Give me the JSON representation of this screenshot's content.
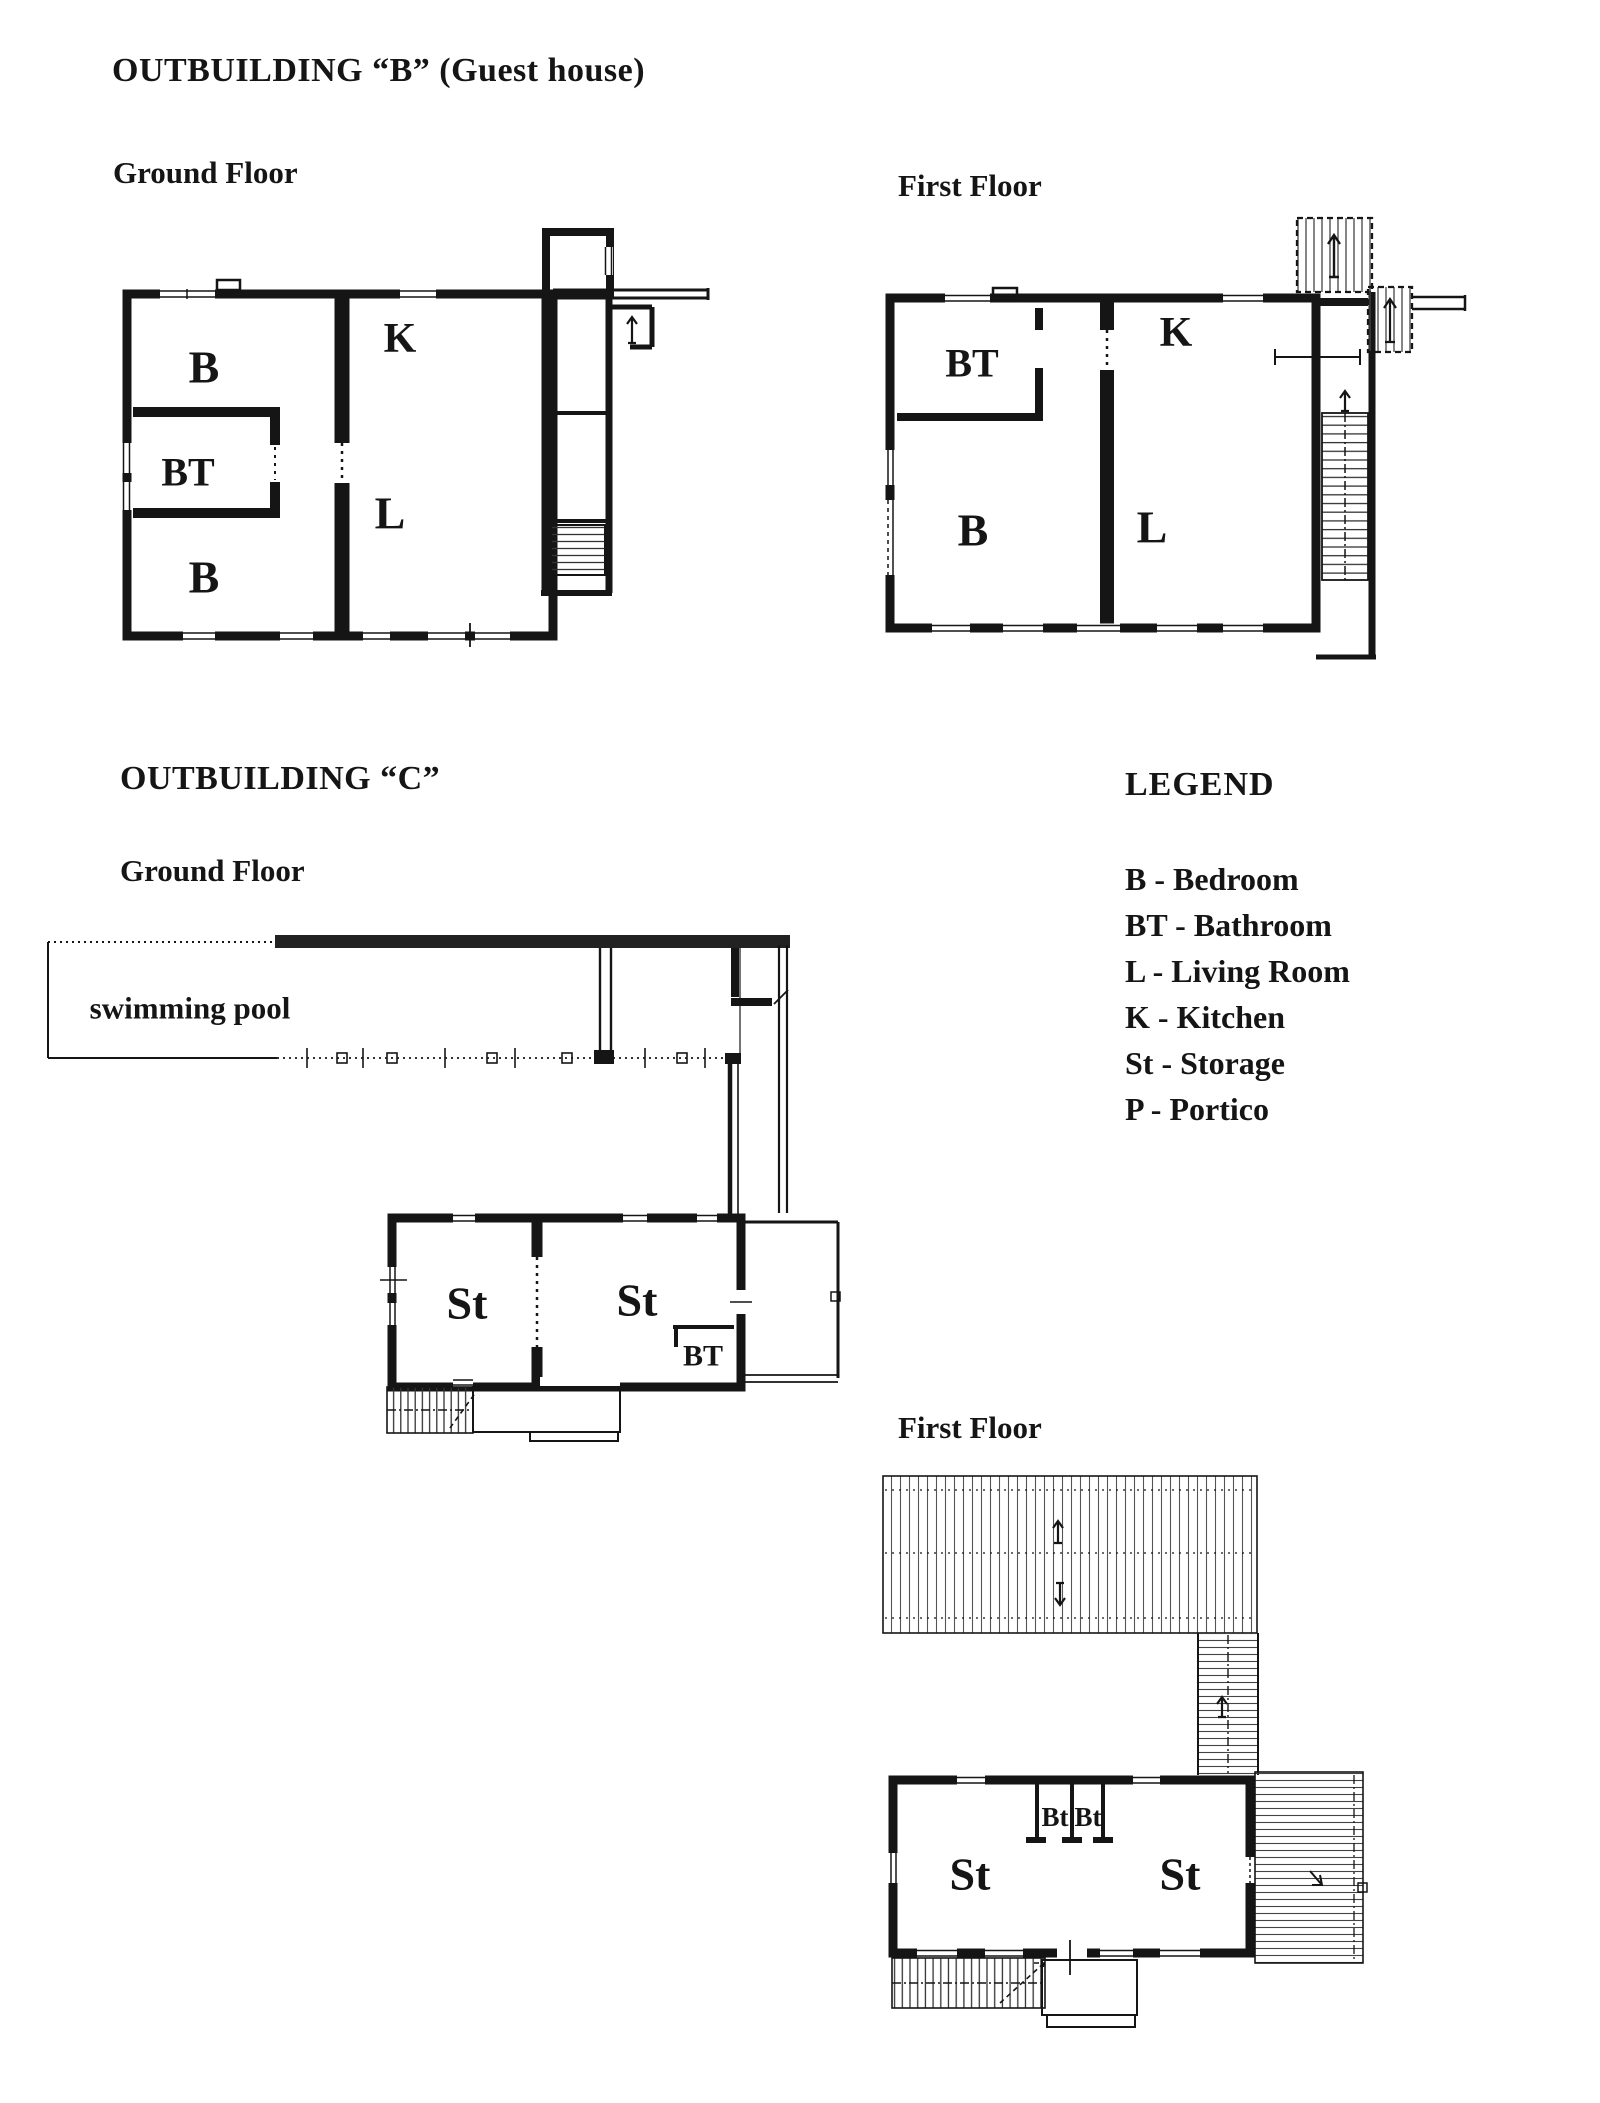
{
  "page": {
    "paper_color": "#ffffff",
    "ink_color": "#151515"
  },
  "outbuilding_b": {
    "title": "OUTBUILDING “B” (Guest house)",
    "ground": {
      "label": "Ground Floor",
      "rooms": {
        "b_top": "B",
        "bt": "BT",
        "b_bottom": "B",
        "k": "K",
        "l": "L"
      }
    },
    "first": {
      "label": "First Floor",
      "rooms": {
        "bt": "BT",
        "b": "B",
        "k": "K",
        "l": "L"
      }
    }
  },
  "outbuilding_c": {
    "title": "OUTBUILDING “C”",
    "ground": {
      "label": "Ground Floor",
      "pool_label": "swimming pool",
      "rooms": {
        "st_left": "St",
        "st_right": "St",
        "bt": "BT"
      }
    },
    "first": {
      "label": "First Floor",
      "rooms": {
        "st_left": "St",
        "bt_left": "Bt",
        "bt_right": "Bt",
        "st_right": "St"
      }
    }
  },
  "legend": {
    "title": "LEGEND",
    "items": [
      "B - Bedroom",
      "BT - Bathroom",
      "L - Living Room",
      "K - Kitchen",
      "St - Storage",
      "P - Portico"
    ]
  }
}
